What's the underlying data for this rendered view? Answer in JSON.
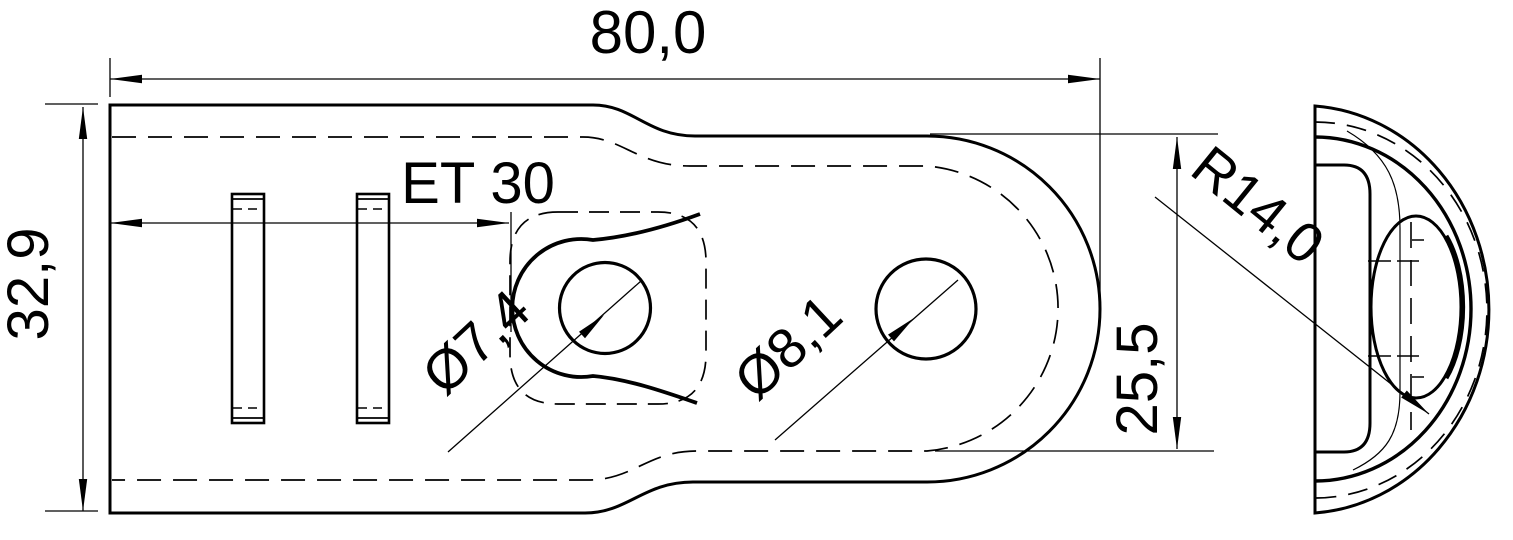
{
  "drawing": {
    "background": "#ffffff",
    "line_color": "#000000",
    "views": {
      "front_view": "front-view",
      "side_view": "side-view"
    },
    "dims": {
      "length_total": "80,0",
      "height_total": "32,9",
      "emboss_spacing": "ET 30",
      "hole_small": "Ø7,4",
      "hole_large": "Ø8,1",
      "height_end": "25,5",
      "radius_end": "R14,0"
    }
  }
}
